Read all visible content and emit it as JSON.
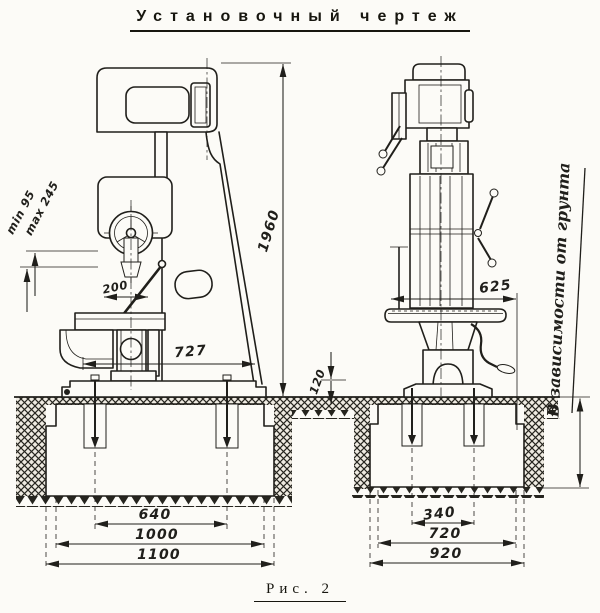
{
  "title": "Установочный чертеж",
  "figure_caption": "Рис. 2",
  "colors": {
    "ink": "#201f1b",
    "paper": "#fcfbf7"
  },
  "drawing": {
    "kind": "installation drawing of a vertical drilling machine, front and side views on a concrete foundation",
    "dims": {
      "overall_height": "1960",
      "spindle_min": "min 95",
      "spindle_max": "max 245",
      "lever_radius": "200",
      "column_to_table": "727",
      "foundation_lip": "120",
      "table_reach": "625",
      "bolts_front": "640",
      "block_front": "1000",
      "pit_front": "1100",
      "bolts_side": "340",
      "block_side": "720",
      "pit_side": "920",
      "depth_note": "В зависимости от грунта"
    }
  }
}
